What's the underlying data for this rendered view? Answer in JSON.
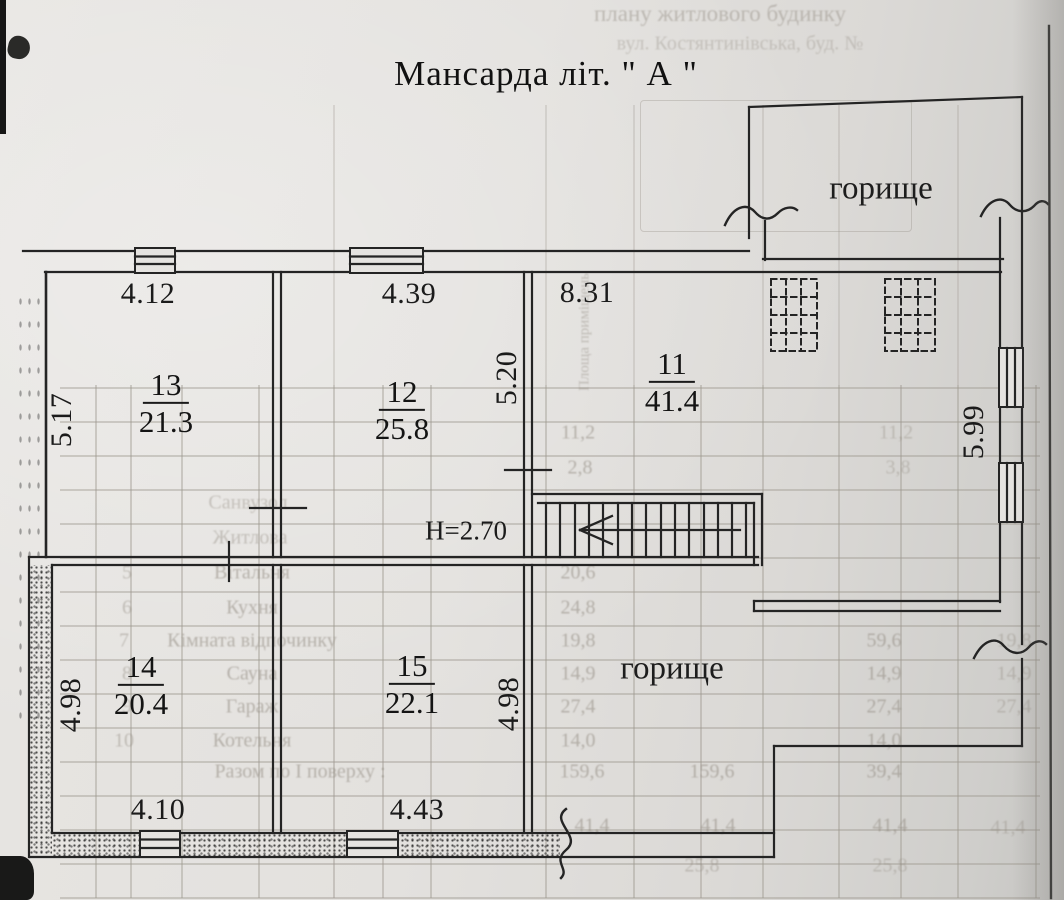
{
  "page": {
    "title": "Мансарда літ. \" А \""
  },
  "plan": {
    "attic_label_top": "горище",
    "attic_label_bottom": "горище",
    "height_label": "H=2.70",
    "line_color": "#242424",
    "paper_color": "#e3e1de",
    "rooms": [
      {
        "number": "13",
        "area": "21.3",
        "x": 166,
        "y": 404
      },
      {
        "number": "12",
        "area": "25.8",
        "x": 402,
        "y": 411
      },
      {
        "number": "11",
        "area": "41.4",
        "x": 672,
        "y": 383
      },
      {
        "number": "14",
        "area": "20.4",
        "x": 141,
        "y": 686
      },
      {
        "number": "15",
        "area": "22.1",
        "x": 412,
        "y": 685
      }
    ],
    "dimensions": [
      {
        "text": "4.12",
        "x": 148,
        "y": 294,
        "rot": 0
      },
      {
        "text": "4.39",
        "x": 409,
        "y": 294,
        "rot": 0
      },
      {
        "text": "8.31",
        "x": 587,
        "y": 293,
        "rot": 0
      },
      {
        "text": "5.17",
        "x": 62,
        "y": 420,
        "rot": -90
      },
      {
        "text": "5.20",
        "x": 507,
        "y": 378,
        "rot": -90
      },
      {
        "text": "5.99",
        "x": 974,
        "y": 432,
        "rot": -90
      },
      {
        "text": "4.98",
        "x": 71,
        "y": 705,
        "rot": -90
      },
      {
        "text": "4.98",
        "x": 509,
        "y": 704,
        "rot": -90
      },
      {
        "text": "4.10",
        "x": 158,
        "y": 810,
        "rot": 0
      },
      {
        "text": "4.43",
        "x": 417,
        "y": 810,
        "rot": 0
      }
    ]
  },
  "bleed": {
    "texts": [
      {
        "t": "плану житлового будинку",
        "x": 720,
        "y": 14,
        "s": 23,
        "o": 0.45
      },
      {
        "t": "вул. Костянтинівська, буд. №",
        "x": 740,
        "y": 44,
        "s": 20,
        "o": 0.35
      },
      {
        "t": "Площа приміщень",
        "x": 585,
        "y": 332,
        "r": -90,
        "s": 15,
        "o": 0.45
      },
      {
        "t": "11,2",
        "x": 578,
        "y": 433
      },
      {
        "t": "11,2",
        "x": 896,
        "y": 433,
        "o": 0.38
      },
      {
        "t": "2,8",
        "x": 580,
        "y": 468
      },
      {
        "t": "3,8",
        "x": 898,
        "y": 468,
        "o": 0.38
      },
      {
        "t": "Санвузол",
        "x": 248,
        "y": 503,
        "o": 0.4
      },
      {
        "t": "Житлова",
        "x": 250,
        "y": 538,
        "o": 0.42
      },
      {
        "t": "5",
        "x": 127,
        "y": 573,
        "o": 0.45
      },
      {
        "t": "Вітальня",
        "x": 252,
        "y": 573
      },
      {
        "t": "20,6",
        "x": 578,
        "y": 573
      },
      {
        "t": "6",
        "x": 127,
        "y": 608,
        "o": 0.45
      },
      {
        "t": "Кухня",
        "x": 252,
        "y": 608
      },
      {
        "t": "24,8",
        "x": 578,
        "y": 608
      },
      {
        "t": "7",
        "x": 124,
        "y": 641,
        "o": 0.45
      },
      {
        "t": "Кімната відпочинку",
        "x": 252,
        "y": 641
      },
      {
        "t": "19,8",
        "x": 578,
        "y": 641
      },
      {
        "t": "59,6",
        "x": 884,
        "y": 641
      },
      {
        "t": "19,8",
        "x": 1014,
        "y": 641,
        "o": 0.4
      },
      {
        "t": "8",
        "x": 127,
        "y": 674,
        "o": 0.45
      },
      {
        "t": "Сауна",
        "x": 252,
        "y": 674
      },
      {
        "t": "14,9",
        "x": 578,
        "y": 674
      },
      {
        "t": "14,9",
        "x": 884,
        "y": 674
      },
      {
        "t": "14,9",
        "x": 1014,
        "y": 674,
        "o": 0.4
      },
      {
        "t": "9",
        "x": 127,
        "y": 707,
        "o": 0.45
      },
      {
        "t": "Гараж",
        "x": 252,
        "y": 707
      },
      {
        "t": "27,4",
        "x": 578,
        "y": 707
      },
      {
        "t": "27,4",
        "x": 884,
        "y": 707
      },
      {
        "t": "27,4",
        "x": 1014,
        "y": 707,
        "o": 0.4
      },
      {
        "t": "10",
        "x": 124,
        "y": 741,
        "o": 0.45
      },
      {
        "t": "Котельня",
        "x": 252,
        "y": 741
      },
      {
        "t": "14,0",
        "x": 578,
        "y": 741
      },
      {
        "t": "14,0",
        "x": 884,
        "y": 741
      },
      {
        "t": "Разом по І поверху :",
        "x": 300,
        "y": 772
      },
      {
        "t": "159,6",
        "x": 582,
        "y": 772
      },
      {
        "t": "159,6",
        "x": 712,
        "y": 772
      },
      {
        "t": "39,4",
        "x": 884,
        "y": 772
      },
      {
        "t": "41,4",
        "x": 592,
        "y": 826
      },
      {
        "t": "41,4",
        "x": 718,
        "y": 826
      },
      {
        "t": "41,4",
        "x": 890,
        "y": 826
      },
      {
        "t": "41,4",
        "x": 1008,
        "y": 828,
        "o": 0.4
      },
      {
        "t": "25,8",
        "x": 702,
        "y": 866,
        "o": 0.42
      },
      {
        "t": "25,8",
        "x": 890,
        "y": 866,
        "o": 0.38
      }
    ]
  }
}
